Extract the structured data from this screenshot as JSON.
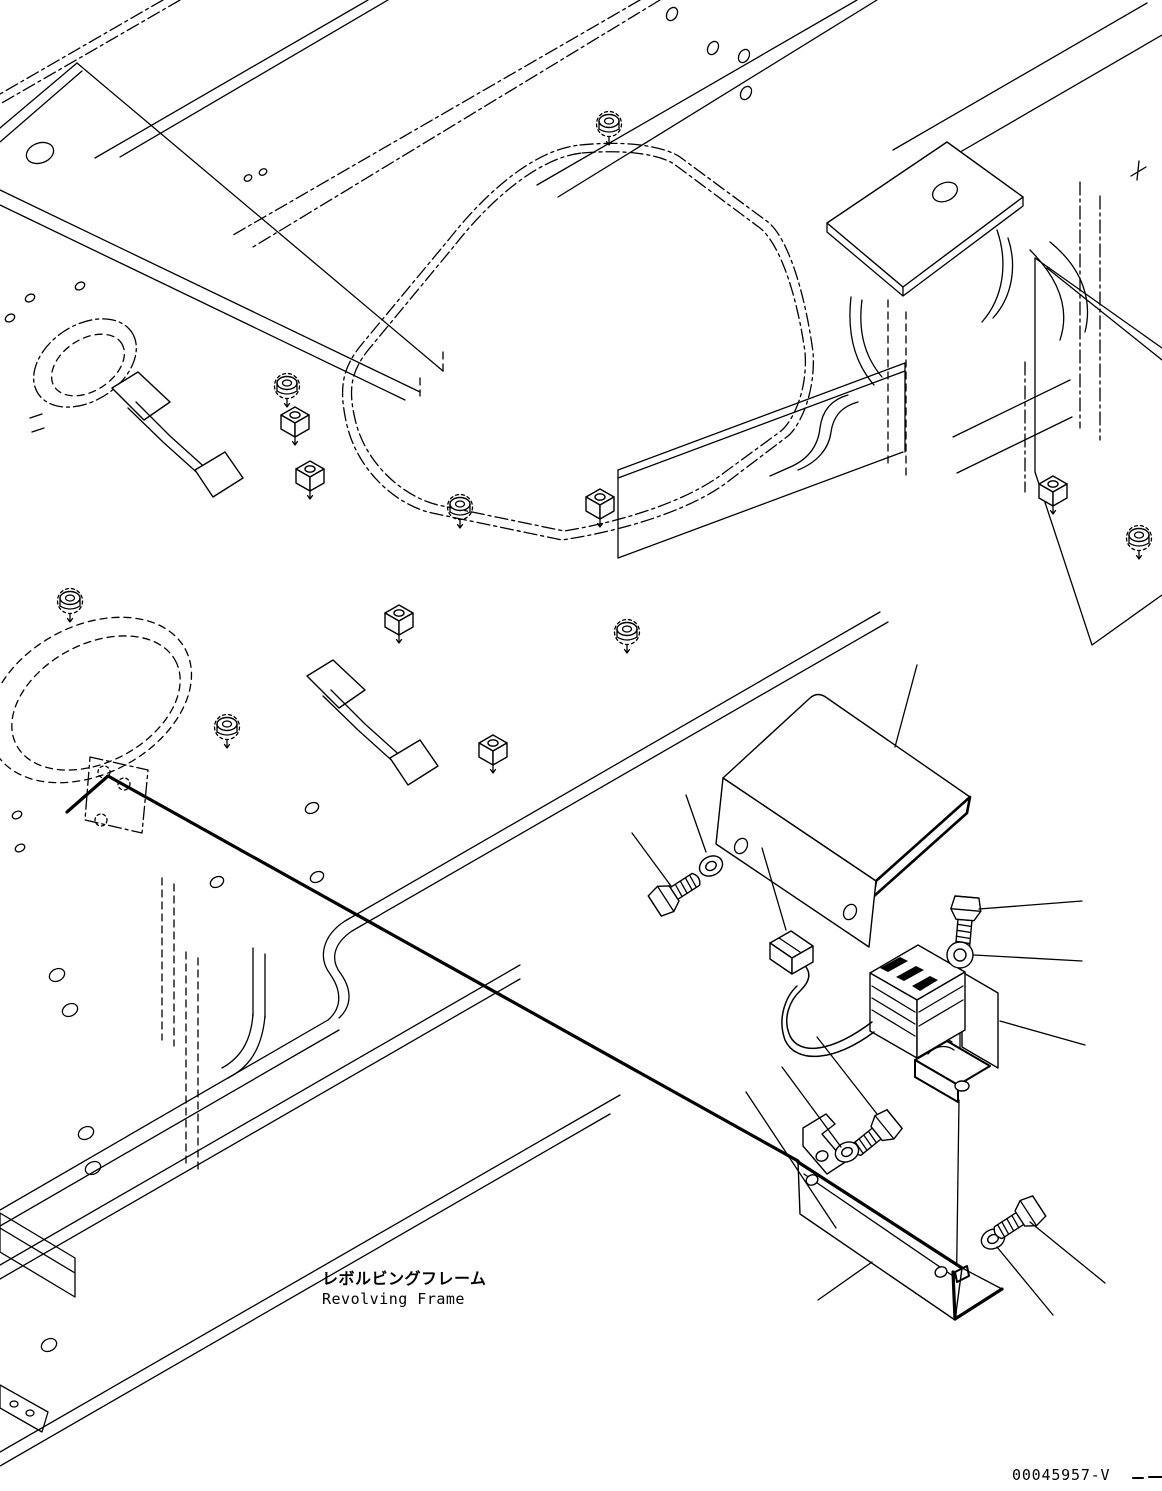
{
  "labels": {
    "frame_jp": "レボルビングフレーム",
    "frame_en": "Revolving Frame",
    "drawing_number": "00045957-V"
  },
  "diagram": {
    "type": "exploded-parts-line-drawing",
    "view": "isometric",
    "colors": {
      "ink": "#000000",
      "paper": "#ffffff"
    }
  }
}
